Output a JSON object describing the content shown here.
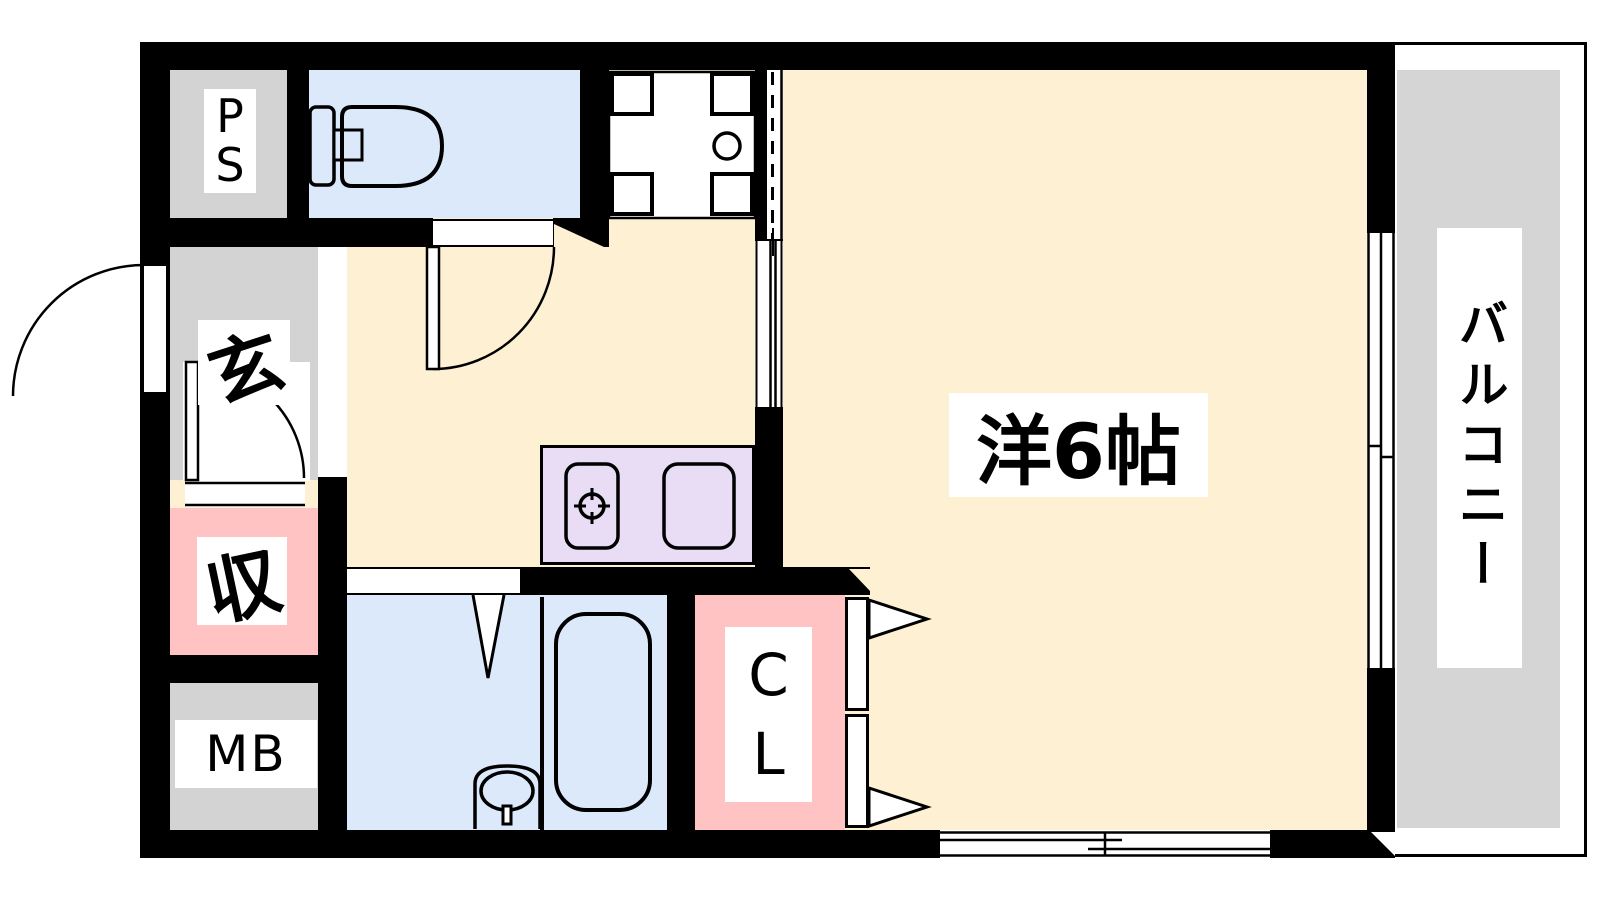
{
  "floor_plan": {
    "type": "apartment-floor-plan",
    "rooms": [
      {
        "id": "ps",
        "label": "PS",
        "display": [
          "P",
          "S"
        ],
        "color": "#d3d3d3"
      },
      {
        "id": "toilet",
        "label": "",
        "color": "#dbe9fb"
      },
      {
        "id": "genkan",
        "label": "玄",
        "color": "#d3d3d3"
      },
      {
        "id": "storage",
        "label": "収",
        "color": "#ffc3c3"
      },
      {
        "id": "meter_box",
        "label": "MB",
        "color": "#d3d3d3"
      },
      {
        "id": "kitchen_hall",
        "label": "",
        "color": "#fdf0d3"
      },
      {
        "id": "bathroom",
        "label": "",
        "color": "#dbe9fb"
      },
      {
        "id": "closet",
        "label": "CL",
        "display": [
          "C",
          "L"
        ],
        "color": "#ffc3c3"
      },
      {
        "id": "western_room",
        "label": "洋6帖",
        "color": "#fdf0d3"
      },
      {
        "id": "balcony",
        "label": "バルコニー",
        "color": "#d5d5d5"
      }
    ],
    "colors": {
      "wall": "#000000",
      "line": "#000000",
      "kitchen_counter": "#e9ddf6",
      "label_background": "#ffffff"
    }
  }
}
